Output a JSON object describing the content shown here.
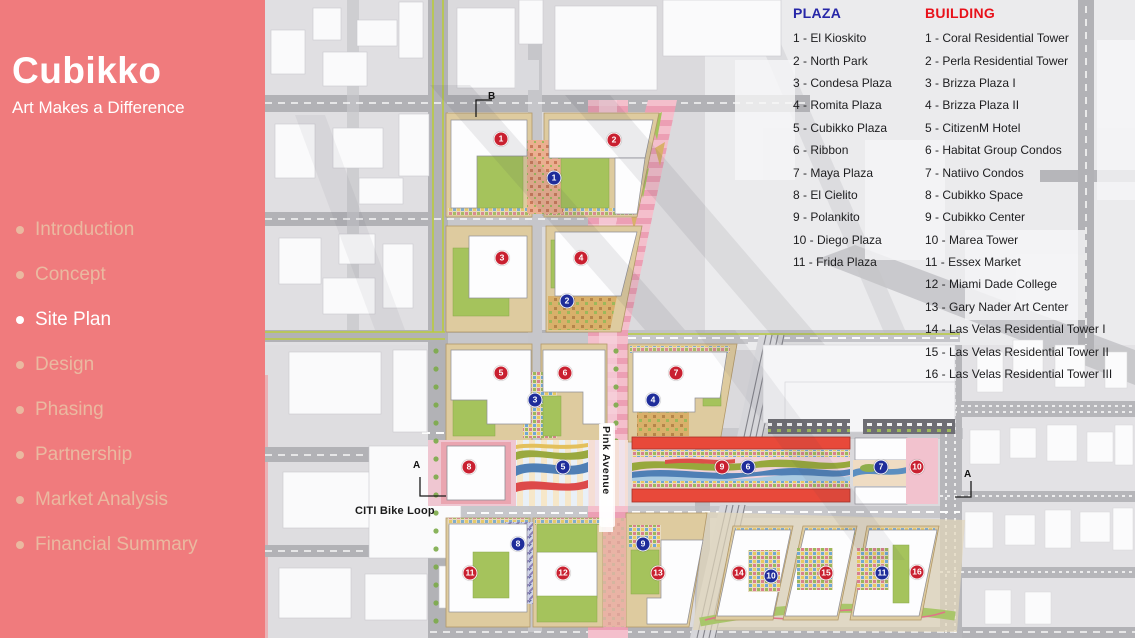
{
  "sidebar": {
    "title": "Cubikko",
    "subtitle": "Art Makes a Difference",
    "nav": [
      {
        "label": "Introduction",
        "active": false
      },
      {
        "label": "Concept",
        "active": false
      },
      {
        "label": "Site Plan",
        "active": true
      },
      {
        "label": "Design",
        "active": false
      },
      {
        "label": "Phasing",
        "active": false
      },
      {
        "label": "Partnership",
        "active": false
      },
      {
        "label": "Market Analysis",
        "active": false
      },
      {
        "label": "Financial Summary",
        "active": false
      }
    ]
  },
  "legend_plaza": {
    "title": "PLAZA",
    "items": [
      "1 - El Kioskito",
      "2 - North Park",
      "3 - Condesa Plaza",
      "4 - Romita Plaza",
      "5 - Cubikko Plaza",
      "6 - Ribbon",
      "7 - Maya Plaza",
      "8 - El Cielito",
      "9 - Polankito",
      "10 - Diego Plaza",
      "11 - Frida Plaza"
    ]
  },
  "legend_building": {
    "title": "BUILDING",
    "items": [
      "1 - Coral Residential Tower",
      "2 - Perla Residential Tower",
      "3 - Brizza Plaza I",
      "4 - Brizza Plaza II",
      "5 - CitizenM Hotel",
      "6 - Habitat Group Condos",
      "7 - Natiivo Condos",
      "8 - Cubikko Space",
      "9 - Cubikko Center",
      "10 - Marea Tower",
      "11 - Essex Market",
      "12 - Miami Dade College",
      "13 - Gary Nader Art Center",
      "14 - Las Velas Residential Tower I",
      "15 - Las Velas Residential Tower II",
      "16 - Las Velas Residential Tower III"
    ]
  },
  "map": {
    "labels": {
      "pink_avenue": "Pink Avenue",
      "citi_bike_loop": "CITI Bike Loop"
    },
    "section_markers": [
      {
        "letter": "B"
      },
      {
        "letter": "A"
      },
      {
        "letter": "A"
      }
    ],
    "markers": [
      {
        "kind": "building",
        "n": 1,
        "x": 236,
        "y": 139
      },
      {
        "kind": "building",
        "n": 2,
        "x": 349,
        "y": 140
      },
      {
        "kind": "building",
        "n": 3,
        "x": 237,
        "y": 258
      },
      {
        "kind": "building",
        "n": 4,
        "x": 316,
        "y": 258
      },
      {
        "kind": "building",
        "n": 5,
        "x": 236,
        "y": 373
      },
      {
        "kind": "building",
        "n": 6,
        "x": 300,
        "y": 373
      },
      {
        "kind": "building",
        "n": 7,
        "x": 411,
        "y": 373
      },
      {
        "kind": "building",
        "n": 8,
        "x": 204,
        "y": 467
      },
      {
        "kind": "building",
        "n": 9,
        "x": 457,
        "y": 467
      },
      {
        "kind": "building",
        "n": 10,
        "x": 652,
        "y": 467
      },
      {
        "kind": "building",
        "n": 11,
        "x": 205,
        "y": 573
      },
      {
        "kind": "building",
        "n": 12,
        "x": 298,
        "y": 573
      },
      {
        "kind": "building",
        "n": 13,
        "x": 393,
        "y": 573
      },
      {
        "kind": "building",
        "n": 14,
        "x": 474,
        "y": 573
      },
      {
        "kind": "building",
        "n": 15,
        "x": 561,
        "y": 573
      },
      {
        "kind": "building",
        "n": 16,
        "x": 652,
        "y": 572
      },
      {
        "kind": "plaza",
        "n": 1,
        "x": 289,
        "y": 178
      },
      {
        "kind": "plaza",
        "n": 2,
        "x": 302,
        "y": 301
      },
      {
        "kind": "plaza",
        "n": 3,
        "x": 270,
        "y": 400
      },
      {
        "kind": "plaza",
        "n": 4,
        "x": 388,
        "y": 400
      },
      {
        "kind": "plaza",
        "n": 5,
        "x": 298,
        "y": 467
      },
      {
        "kind": "plaza",
        "n": 6,
        "x": 483,
        "y": 467
      },
      {
        "kind": "plaza",
        "n": 7,
        "x": 616,
        "y": 467
      },
      {
        "kind": "plaza",
        "n": 8,
        "x": 253,
        "y": 544
      },
      {
        "kind": "plaza",
        "n": 9,
        "x": 378,
        "y": 544
      },
      {
        "kind": "plaza",
        "n": 10,
        "x": 506,
        "y": 576
      },
      {
        "kind": "plaza",
        "n": 11,
        "x": 617,
        "y": 573
      }
    ]
  },
  "colors": {
    "sidebar_bg": "#f07b7d",
    "sidebar_inactive": "#eab9a0",
    "plaza_title": "#2626a8",
    "building_title": "#e8111a",
    "marker_building": "#c92030",
    "marker_plaza": "#1f2d9a"
  }
}
